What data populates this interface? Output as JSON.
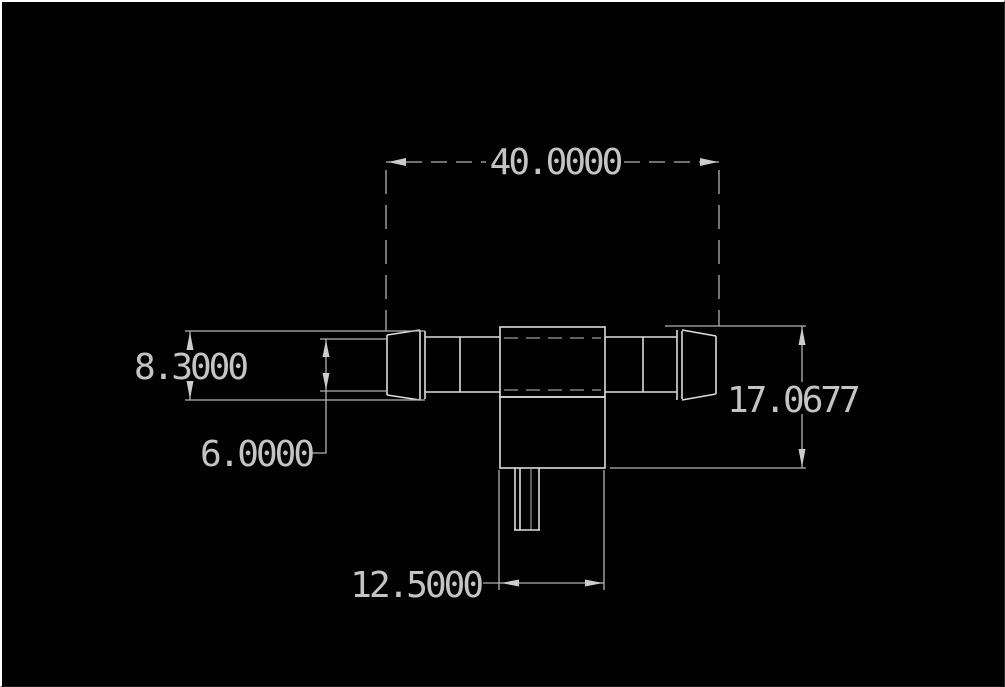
{
  "app": {
    "type": "cad-drawing-view",
    "description": "2D engineering drawing (side view) of a barbed T-fitting on a black model-space canvas"
  },
  "canvas": {
    "background_color": "#020202",
    "frame_color": "#ffffff",
    "geometry_line_color": "#dcdcdc",
    "dimension_line_color": "#b2b2b2",
    "dimension_text_color": "#c4c4c4"
  },
  "dimensions": {
    "overall_length": "40.0000",
    "barb_diameter": "8.3000",
    "tube_diameter": "6.0000",
    "overall_height": "17.0677",
    "stem_width": "12.5000"
  }
}
